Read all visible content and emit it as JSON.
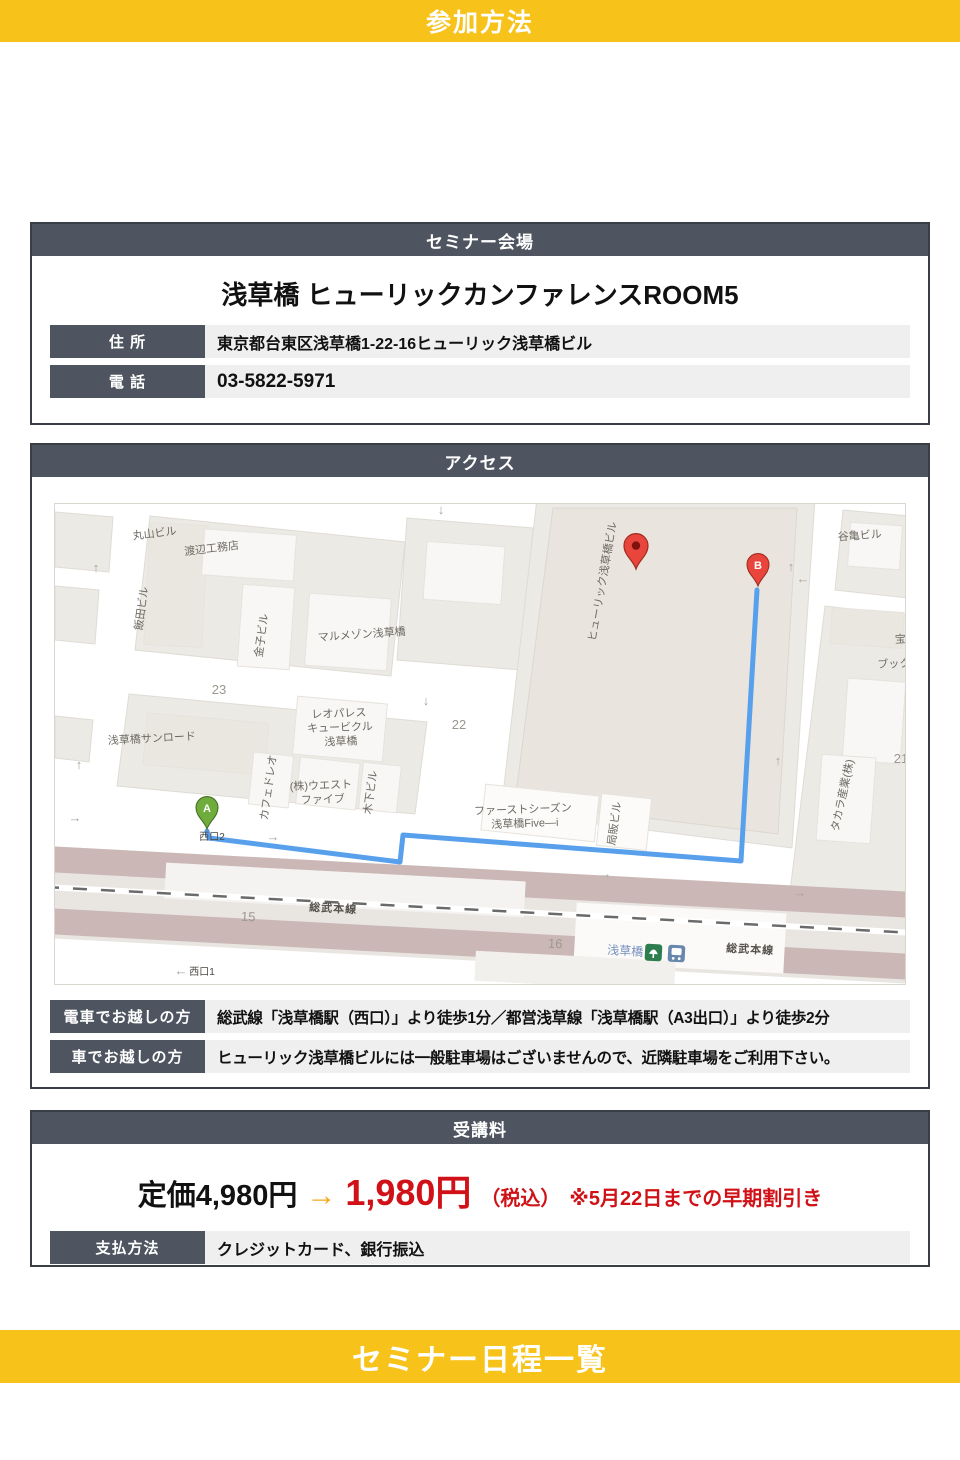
{
  "page": {
    "top_banner": "参加方法",
    "bottom_banner": "セミナー日程一覧"
  },
  "venue": {
    "header": "セミナー会場",
    "title": "浅草橋 ヒューリックカンファレンスROOM5",
    "rows": [
      {
        "label": "住 所",
        "value": "東京都台東区浅草橋1-22-16ヒューリック浅草橋ビル"
      },
      {
        "label": "電 話",
        "value": "03-5822-5971"
      }
    ]
  },
  "access": {
    "header": "アクセス",
    "rows": [
      {
        "label": "電車でお越しの方",
        "value": "総武線「浅草橋駅（西口）」より徒歩1分／都営浅草線「浅草橋駅（A3出口）」より徒歩2分"
      },
      {
        "label": "車でお越しの方",
        "value": "ヒューリック浅草橋ビルには一般駐車場はございませんので、近隣駐車場をご利用下さい。"
      }
    ]
  },
  "fee": {
    "header": "受講料",
    "regular_price": "定価4,980円",
    "arrow": "→",
    "discount_price": "1,980円",
    "tax_note": "（税込）",
    "deadline_note": "※5月22日までの早期割引き",
    "rows": [
      {
        "label": "支払方法",
        "value": "クレジットカード、銀行振込"
      }
    ]
  },
  "colors": {
    "banner_yellow": "#F7C21A",
    "header_slate": "#4E5460",
    "row_bg": "#EFEFEF",
    "price_red": "#D01218",
    "arrow_orange": "#F5A81C",
    "route_blue": "#58A0EC",
    "pin_red": "#E8453C",
    "pin_green": "#6FAC3C",
    "railway_mauve": "#CBB8B6"
  },
  "map": {
    "marker_a_label": "A",
    "marker_b_label": "B",
    "labels": [
      {
        "t": "丸山ビル",
        "x": 100,
        "y": 33,
        "r": -7,
        "c": "bldg"
      },
      {
        "t": "渡辺工務店",
        "x": 157,
        "y": 48,
        "r": -7,
        "c": "bldg"
      },
      {
        "t": "飯田ビル",
        "x": 90,
        "y": 105,
        "r": -82,
        "c": "bldg"
      },
      {
        "t": "金子ビル",
        "x": 210,
        "y": 132,
        "r": -82,
        "c": "bldg"
      },
      {
        "t": "マルメゾン浅草橋",
        "x": 307,
        "y": 134,
        "r": -4,
        "c": "bldg"
      },
      {
        "t": "23",
        "x": 164,
        "y": 190,
        "r": 0,
        "c": "num"
      },
      {
        "t": "浅草橋サンロード",
        "x": 97,
        "y": 238,
        "r": -3,
        "c": "bldg"
      },
      {
        "t": "レオパレス",
        "x": 284,
        "y": 213,
        "r": -2,
        "c": "bldg"
      },
      {
        "t": "キュービクル",
        "x": 285,
        "y": 227,
        "r": -2,
        "c": "bldg"
      },
      {
        "t": "浅草橋",
        "x": 286,
        "y": 241,
        "r": -2,
        "c": "bldg"
      },
      {
        "t": "カフェドレオ",
        "x": 217,
        "y": 284,
        "r": -82,
        "c": "bldg"
      },
      {
        "t": "(株)ウエスト",
        "x": 266,
        "y": 285,
        "r": -2,
        "c": "bldg"
      },
      {
        "t": "ファイブ",
        "x": 268,
        "y": 299,
        "r": -2,
        "c": "bldg"
      },
      {
        "t": "木下ビル",
        "x": 319,
        "y": 289,
        "r": -82,
        "c": "bldg"
      },
      {
        "t": "22",
        "x": 404,
        "y": 225,
        "r": 0,
        "c": "num"
      },
      {
        "t": "ヒューリック浅草橋ビル",
        "x": 551,
        "y": 78,
        "r": -80,
        "c": "bldg"
      },
      {
        "t": "ファーストシーズン",
        "x": 468,
        "y": 309,
        "r": -2,
        "c": "bldg"
      },
      {
        "t": "浅草橋Five—i",
        "x": 470,
        "y": 323,
        "r": -2,
        "c": "bldg"
      },
      {
        "t": "局販ビル",
        "x": 563,
        "y": 320,
        "r": -82,
        "c": "bldg"
      },
      {
        "t": "谷亀ビル",
        "x": 805,
        "y": 35,
        "r": -4,
        "c": "bldg"
      },
      {
        "t": "宝山ビル",
        "x": 862,
        "y": 138,
        "r": -3,
        "c": "bldg"
      },
      {
        "t": "ブックマー",
        "x": 850,
        "y": 163,
        "r": -2,
        "c": "bldg"
      },
      {
        "t": "21",
        "x": 846,
        "y": 259,
        "r": 0,
        "c": "num"
      },
      {
        "t": "タカラ産業(株)",
        "x": 791,
        "y": 292,
        "r": -78,
        "c": "bldg"
      },
      {
        "t": "西口2",
        "x": 157,
        "y": 336,
        "r": 0,
        "c": "exit"
      },
      {
        "t": "15",
        "x": 193,
        "y": 417,
        "r": 3,
        "c": "num"
      },
      {
        "t": "16",
        "x": 500,
        "y": 444,
        "r": 3,
        "c": "num"
      },
      {
        "t": "総武本線",
        "x": 278,
        "y": 408,
        "r": 3,
        "c": "rail"
      },
      {
        "t": "総武本線",
        "x": 695,
        "y": 449,
        "r": 3,
        "c": "rail"
      },
      {
        "t": "浅草橋",
        "x": 570,
        "y": 451,
        "r": 3,
        "c": "station"
      },
      {
        "t": "西口1",
        "x": 147,
        "y": 471,
        "r": 0,
        "c": "exit"
      },
      {
        "t": "←",
        "x": 126,
        "y": 471,
        "r": 0,
        "c": "arrowg"
      },
      {
        "t": "↑",
        "x": 41,
        "y": 68,
        "r": 0,
        "c": "arrowg"
      },
      {
        "t": "↓",
        "x": 371,
        "y": 201,
        "r": 0,
        "c": "arrowg"
      },
      {
        "t": "↓",
        "x": 386,
        "y": 10,
        "r": 0,
        "c": "arrowg"
      },
      {
        "t": "↑",
        "x": 736,
        "y": 67,
        "r": 0,
        "c": "arrowg"
      },
      {
        "t": "←",
        "x": 748,
        "y": 79,
        "r": 0,
        "c": "arrowg"
      },
      {
        "t": "↑",
        "x": 723,
        "y": 261,
        "r": 0,
        "c": "arrowg"
      },
      {
        "t": "↑",
        "x": 24,
        "y": 265,
        "r": 0,
        "c": "arrowg"
      },
      {
        "t": "→",
        "x": 20,
        "y": 318,
        "r": 0,
        "c": "arrowg"
      },
      {
        "t": "→",
        "x": 218,
        "y": 337,
        "r": 0,
        "c": "arrowg"
      },
      {
        "t": "→",
        "x": 550,
        "y": 374,
        "r": 0,
        "c": "arrowg"
      },
      {
        "t": "→",
        "x": 745,
        "y": 393,
        "r": 0,
        "c": "arrowg"
      }
    ]
  }
}
